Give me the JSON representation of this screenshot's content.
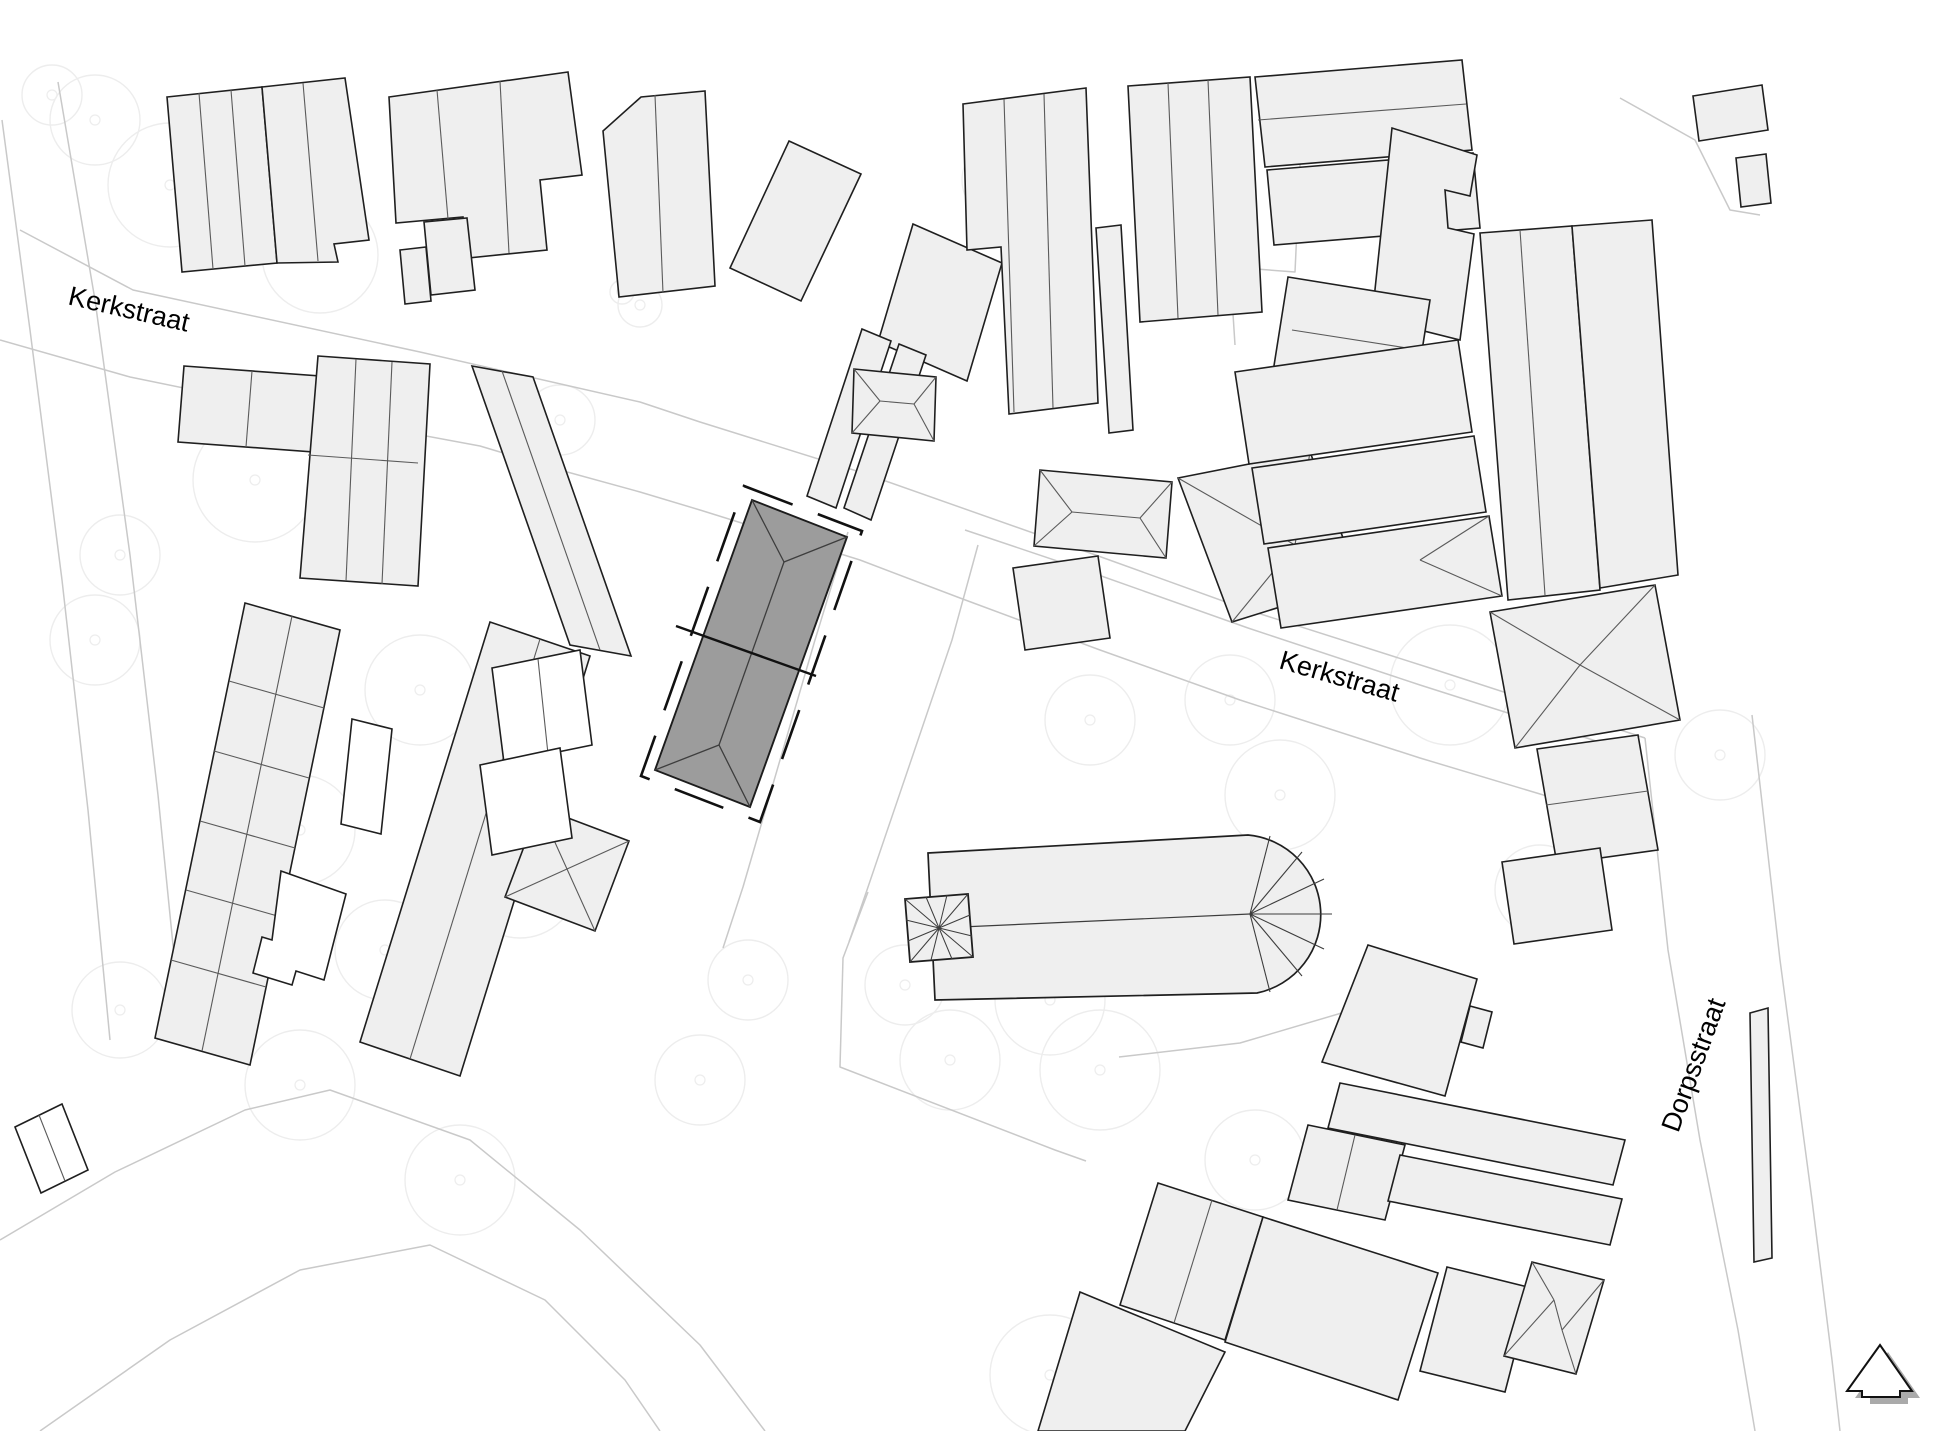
{
  "map": {
    "type": "architectural-site-plan",
    "width": 1945,
    "height": 1431,
    "colors": {
      "background": "#ffffff",
      "building_fill": "#efefef",
      "building_stroke": "#1f1f1f",
      "division_line": "#5a5a5a",
      "white_fill": "#ffffff",
      "hero_fill": "#9c9c9c",
      "hero_stroke": "#1c1c1c",
      "roof_line": "#3d3d3d",
      "parcel_line": "#c9c9c9",
      "tree_line": "#ededed",
      "boundary_dash": "#111111",
      "label_color": "#000000",
      "shadow": "#aaaaaa"
    },
    "labels": [
      {
        "id": "street-label-kerkstraat-west",
        "text": "Kerkstraat",
        "x": 127,
        "y": 318,
        "rotation": 13,
        "size": 27
      },
      {
        "id": "street-label-kerkstraat-east",
        "text": "Kerkstraat",
        "x": 1337,
        "y": 685,
        "rotation": 16,
        "size": 27
      },
      {
        "id": "street-label-dorpsstraat",
        "text": "Dorpsstraat",
        "x": 1702,
        "y": 1068,
        "rotation": -70,
        "size": 27
      }
    ],
    "north_arrow": {
      "points": "1880,1345 1912,1391 1900,1391 1900,1397 1862,1397 1862,1391 1847,1391",
      "shadow_dx": 8,
      "shadow_dy": 7
    },
    "parcel_lines": [
      "20,230 133,290 420,352 640,402 700,422 860,472 1090,553 1248,610 1430,668 1645,738",
      "0,340 130,377 340,420 480,446 560,470 640,492 700,510 860,560 960,598 1100,650 1240,700 1420,758 1560,800 1645,830",
      "965,530 1090,572 1248,628 1420,685 1640,755",
      "1645,738 1668,950 1700,1140 1738,1330 1755,1431",
      "1752,715 1780,960 1812,1200 1832,1360 1840,1431",
      "0,1240 115,1172 245,1110 330,1090 470,1140 580,1230 700,1345 765,1431",
      "40,1431 170,1340 300,1270 430,1245 545,1300 625,1380 660,1431",
      "58,82 95,300 130,555 158,795 182,1035",
      "2,120 30,330 62,580 88,810 110,1040",
      "848,532 815,640 743,887 723,948",
      "978,545 952,640 867,890 849,942",
      "868,892 843,958 840,1067 1055,1150 1086,1161",
      "1119,1057 1240,1043 1345,1012 1420,1000",
      "1383,110 1302,121 1295,272 1230,267 1235,345",
      "1620,98 1695,140 1730,210 1760,215"
    ],
    "trees": [
      [
        95,
        120,
        45
      ],
      [
        170,
        185,
        62
      ],
      [
        320,
        255,
        58
      ],
      [
        52,
        95,
        30
      ],
      [
        255,
        480,
        62
      ],
      [
        120,
        555,
        40
      ],
      [
        95,
        640,
        45
      ],
      [
        420,
        690,
        55
      ],
      [
        300,
        830,
        55
      ],
      [
        520,
        880,
        58
      ],
      [
        385,
        950,
        50
      ],
      [
        120,
        1010,
        48
      ],
      [
        300,
        1085,
        55
      ],
      [
        460,
        1180,
        55
      ],
      [
        560,
        420,
        35
      ],
      [
        640,
        305,
        22
      ],
      [
        622,
        292,
        12
      ],
      [
        1000,
        180,
        38
      ],
      [
        1090,
        720,
        45
      ],
      [
        1230,
        700,
        45
      ],
      [
        1280,
        795,
        55
      ],
      [
        1450,
        685,
        60
      ],
      [
        1540,
        890,
        45
      ],
      [
        1050,
        1000,
        55
      ],
      [
        950,
        1060,
        50
      ],
      [
        1100,
        1070,
        60
      ],
      [
        1255,
        1160,
        50
      ],
      [
        1050,
        1375,
        60
      ],
      [
        1305,
        1300,
        45
      ],
      [
        1720,
        755,
        45
      ],
      [
        905,
        985,
        40
      ],
      [
        748,
        980,
        40
      ],
      [
        700,
        1080,
        45
      ]
    ],
    "buildings": [
      {
        "pts": "167,97 262,87 277,263 182,272",
        "fill": "b",
        "lines": [
          "199,93 213,269",
          "231,90 245,266"
        ]
      },
      {
        "pts": "262,87 345,78 369,240 334,244 338,262 277,263",
        "fill": "b",
        "lines": [
          "303,83 318,261"
        ]
      },
      {
        "pts": "389,97 568,72 582,175 540,180 547,250 468,258 463,217 396,223",
        "fill": "b",
        "lines": [
          "437,90 448,219",
          "500,81 509,253"
        ]
      },
      {
        "pts": "424,222 467,218 475,290 431,295",
        "fill": "b",
        "lines": []
      },
      {
        "pts": "400,250 426,247 431,301 405,304",
        "fill": "b",
        "lines": []
      },
      {
        "pts": "603,131 641,97 705,91 715,286 619,297",
        "fill": "b",
        "lines": [
          "655,95 663,293"
        ]
      },
      {
        "pts": "789,141 861,174 801,301 730,268",
        "fill": "b",
        "lines": []
      },
      {
        "pts": "913,224 1002,263 967,381 878,342",
        "fill": "b",
        "lines": []
      },
      {
        "pts": "862,329 891,341 836,508 807,496",
        "fill": "b",
        "lines": []
      },
      {
        "pts": "899,344 926,355 871,520 844,508",
        "fill": "b",
        "lines": []
      },
      {
        "pts": "963,104 1086,88 1098,403 1009,414 1001,247 967,250",
        "fill": "b",
        "lines": [
          "1004,99 1014,412",
          "1044,94 1053,408"
        ]
      },
      {
        "pts": "1096,228 1121,225 1133,430 1109,433",
        "fill": "b",
        "lines": []
      },
      {
        "pts": "854,369 936,377 934,441 852,433",
        "fill": "b",
        "lines": [
          "854,369 880,401",
          "852,433 880,401",
          "880,401 914,404",
          "936,377 914,404",
          "934,441 914,404"
        ]
      },
      {
        "pts": "1040,470 1172,482 1166,558 1034,546",
        "fill": "b",
        "lines": [
          "1040,470 1072,512",
          "1034,546 1072,512",
          "1072,512 1140,518",
          "1172,482 1140,518",
          "1166,558 1140,518"
        ]
      },
      {
        "pts": "1178,478 1310,452 1360,582 1232,622",
        "fill": "b",
        "lines": [
          "1178,478 1295,545",
          "1310,452 1295,545",
          "1360,582 1295,545",
          "1232,622 1295,545"
        ]
      },
      {
        "pts": "1128,86 1250,77 1262,312 1140,322",
        "fill": "b",
        "lines": [
          "1168,83 1178,318",
          "1208,80 1218,315"
        ]
      },
      {
        "pts": "1255,77 1462,60 1472,150 1265,167",
        "fill": "b",
        "lines": [
          "1258,120 1466,104"
        ]
      },
      {
        "pts": "1267,170 1473,153 1480,228 1274,245",
        "fill": "b",
        "lines": []
      },
      {
        "pts": "1392,128 1477,155 1470,196 1445,190 1448,228 1474,234 1460,340 1372,318",
        "fill": "b",
        "lines": []
      },
      {
        "pts": "1288,277 1430,300 1415,395 1273,372",
        "fill": "b",
        "lines": [
          "1292,330 1420,350"
        ]
      },
      {
        "pts": "1235,372 1458,340 1472,432 1249,464",
        "fill": "b",
        "lines": []
      },
      {
        "pts": "1252,468 1474,436 1486,512 1264,544",
        "fill": "b",
        "lines": []
      },
      {
        "pts": "1268,548 1489,516 1502,596 1281,628",
        "fill": "b",
        "lines": [
          "1502,596 1420,560",
          "1489,516 1420,560"
        ]
      },
      {
        "pts": "1480,233 1572,226 1600,590 1508,600",
        "fill": "b",
        "lines": [
          "1520,230 1545,595"
        ]
      },
      {
        "pts": "1572,226 1652,220 1678,575 1600,588",
        "fill": "b",
        "lines": []
      },
      {
        "pts": "1693,96 1762,85 1768,130 1699,141",
        "fill": "b",
        "lines": []
      },
      {
        "pts": "1736,158 1766,154 1771,203 1741,207",
        "fill": "b",
        "lines": []
      },
      {
        "pts": "1490,612 1655,585 1680,720 1515,748",
        "fill": "b",
        "lines": [
          "1490,612 1580,665",
          "1655,585 1580,665",
          "1680,720 1580,665",
          "1515,748 1580,665"
        ]
      },
      {
        "pts": "1013,568 1098,556 1110,638 1025,650",
        "fill": "b",
        "lines": []
      },
      {
        "pts": "1537,749 1638,735 1658,850 1557,864",
        "fill": "b",
        "lines": [
          "1546,805 1648,791"
        ]
      },
      {
        "pts": "1502,862 1600,848 1612,930 1514,944",
        "fill": "b",
        "lines": []
      },
      {
        "pts": "1368,945 1477,979 1445,1096 1322,1062",
        "fill": "b",
        "lines": []
      },
      {
        "pts": "1470,1006 1492,1012 1483,1048 1461,1042",
        "fill": "b",
        "lines": []
      },
      {
        "pts": "1340,1083 1625,1140 1613,1185 1328,1128",
        "fill": "b",
        "lines": []
      },
      {
        "pts": "1308,1125 1405,1145 1385,1220 1288,1200",
        "fill": "b",
        "lines": [
          "1355,1135 1337,1210"
        ]
      },
      {
        "pts": "1400,1155 1622,1199 1610,1245 1388,1201",
        "fill": "b",
        "lines": []
      },
      {
        "pts": "1158,1183 1263,1217 1225,1340 1120,1305",
        "fill": "b",
        "lines": [
          "1212,1200 1174,1323"
        ]
      },
      {
        "pts": "1263,1217 1438,1273 1398,1400 1225,1342",
        "fill": "b",
        "lines": []
      },
      {
        "pts": "1080,1292 1225,1352 1185,1431 1038,1431",
        "fill": "b",
        "lines": []
      },
      {
        "pts": "1447,1267 1532,1288 1505,1392 1420,1371",
        "fill": "b",
        "lines": []
      },
      {
        "pts": "1532,1262 1604,1280 1576,1374 1504,1356",
        "fill": "b",
        "lines": [
          "1532,1262 1554,1300",
          "1504,1356 1554,1300",
          "1554,1300 1562,1330",
          "1604,1280 1562,1330",
          "1576,1374 1562,1330"
        ]
      },
      {
        "pts": "1750,1013 1768,1008 1772,1258 1754,1262",
        "fill": "b",
        "lines": []
      },
      {
        "pts": "184,366 320,376 314,452 178,442",
        "fill": "b",
        "lines": [
          "252,371 246,447"
        ]
      },
      {
        "pts": "318,356 430,364 418,586 300,578",
        "fill": "b",
        "lines": [
          "356,359 346,581",
          "392,362 382,584",
          "308,455 418,463"
        ]
      },
      {
        "pts": "472,366 533,377 631,656 570,645",
        "fill": "b",
        "lines": [
          "502,371 600,650"
        ]
      },
      {
        "pts": "490,622 590,656 460,1076 360,1042",
        "fill": "b",
        "lines": [
          "540,639 410,1059"
        ]
      },
      {
        "pts": "245,603 340,630 250,1065 155,1038",
        "fill": "b",
        "lines": [
          "292,616 202,1051",
          "229,681 324,708",
          "214,751 309,778",
          "200,821 295,848",
          "186,890 281,917",
          "171,960 266,987"
        ]
      },
      {
        "pts": "539,807 629,841 595,931 505,897",
        "fill": "b",
        "lines": [
          "539,807 595,931",
          "629,841 505,897"
        ]
      },
      {
        "pts": "281,871 346,894 324,980 296,971 292,985 253,973 262,937 272,940",
        "fill": "w",
        "lines": []
      },
      {
        "pts": "352,719 392,729 381,834 341,824",
        "fill": "w",
        "lines": []
      },
      {
        "pts": "15,1127 62,1104 88,1170 41,1193",
        "fill": "w",
        "lines": [
          "39,1115 65,1181"
        ]
      },
      {
        "pts": "492,668 580,650 592,745 504,763",
        "fill": "w",
        "lines": [
          "538,659 548,754"
        ]
      },
      {
        "pts": "480,765 560,748 572,838 492,855",
        "fill": "w",
        "lines": []
      }
    ],
    "hero": {
      "pts": "752,500 847,537 750,807 655,770",
      "roof_lines": [
        "784,562 719,745",
        "752,500 784,562",
        "847,537 784,562",
        "655,770 719,745",
        "750,807 719,745"
      ],
      "boundary_pts": "744,486 862,531 760,822 641,776",
      "cross_line": "676,626 816,676"
    },
    "church": {
      "tower_pts": "905,899 968,894 973,957 910,962",
      "tower_center": [
        939,
        928
      ],
      "tower_rays": [
        "939,928 905,899",
        "939,928 968,894",
        "939,928 973,957",
        "939,928 910,962",
        "939,928 926,897",
        "939,928 947,895",
        "939,928 970,915",
        "939,928 972,936",
        "939,928 952,959",
        "939,928 931,960",
        "939,928 908,941",
        "939,928 906,920"
      ],
      "nave_path": "M 928,853 L 1248,835 A 80,80 0 0 1 1257,993 L 935,1000 Z",
      "ridge": "939,928 1250,914",
      "apse_rays": [
        "1250,914 1270,836",
        "1250,914 1302,852",
        "1250,914 1324,879",
        "1250,914 1332,914",
        "1250,914 1324,949",
        "1250,914 1302,976",
        "1250,914 1270,992"
      ]
    }
  }
}
